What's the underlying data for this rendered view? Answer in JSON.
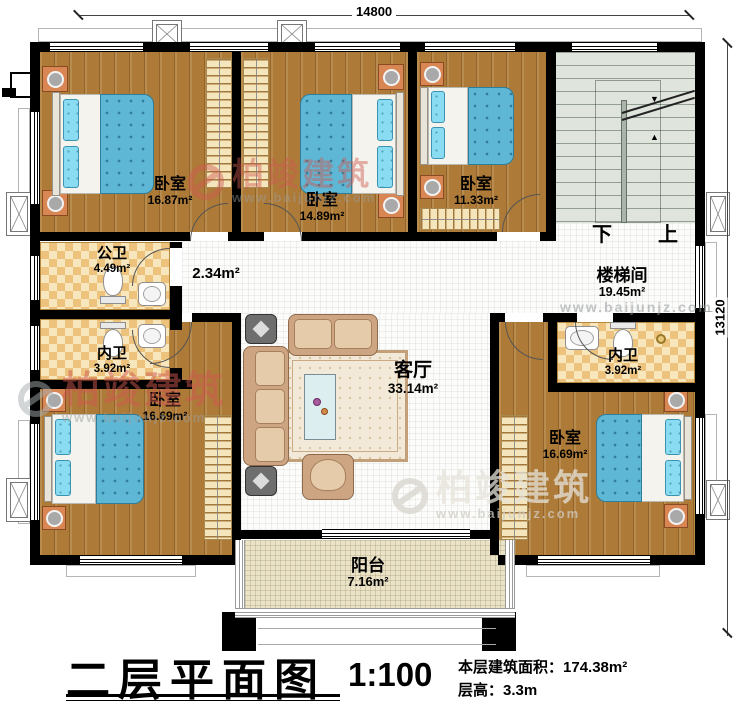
{
  "dimensions": {
    "width": "14800",
    "height": "13120"
  },
  "rooms": {
    "bedroom_tl": {
      "name": "卧室",
      "area": "16.87m²"
    },
    "bedroom_tm": {
      "name": "卧室",
      "area": "14.89m²"
    },
    "bedroom_tr": {
      "name": "卧室",
      "area": "11.33m²"
    },
    "stairwell": {
      "name": "楼梯间",
      "area": "19.45m²"
    },
    "public_bath": {
      "name": "公卫",
      "area": "4.49m²"
    },
    "hallway": {
      "area": "2.34m²"
    },
    "bath_left": {
      "name": "内卫",
      "area": "3.92m²"
    },
    "bedroom_bl": {
      "name": "卧室",
      "area": "16.69m²"
    },
    "living": {
      "name": "客厅",
      "area": "33.14m²"
    },
    "bath_right": {
      "name": "内卫",
      "area": "3.92m²"
    },
    "bedroom_br": {
      "name": "卧室",
      "area": "16.69m²"
    },
    "balcony": {
      "name": "阳台",
      "area": "7.16m²"
    }
  },
  "stairs": {
    "down": "下",
    "up": "上"
  },
  "title_block": {
    "title": "二层平面图",
    "scale": "1:100",
    "area_label": "本层建筑面积：",
    "area_value": "174.38m²",
    "height_label": "层高：",
    "height_value": "3.3m"
  },
  "watermark": {
    "brand": "柏竣建筑",
    "url": "www.baijunjz.com"
  }
}
